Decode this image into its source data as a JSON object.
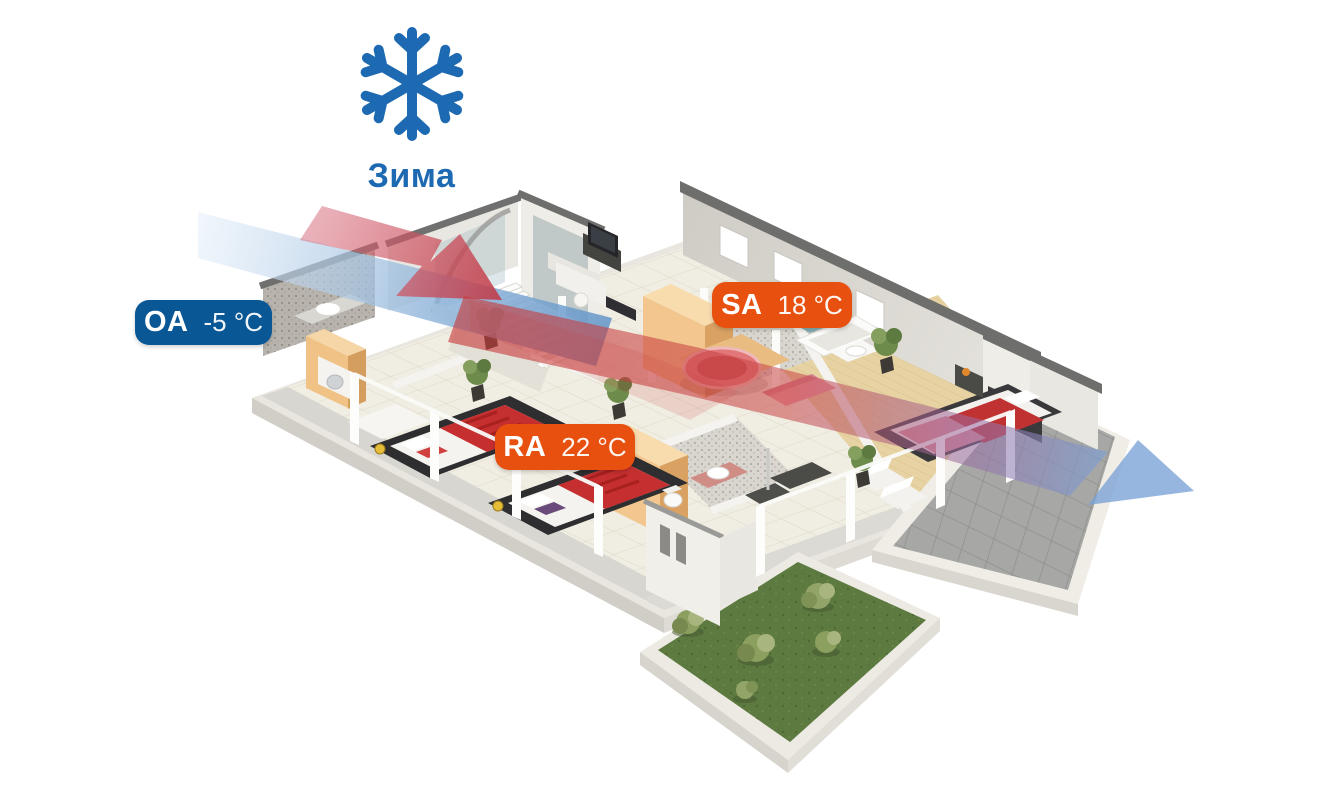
{
  "season": {
    "label": "Зима",
    "icon": "snowflake-icon",
    "color": "#1d6ab3"
  },
  "flows": [
    {
      "code": "OA",
      "temperature": "-5 °C",
      "badge_color": "#0a5796",
      "position": "outdoor-air-left"
    },
    {
      "code": "SA",
      "temperature": "18 °C",
      "badge_color": "#e8500f",
      "position": "supply-air-center"
    },
    {
      "code": "RA",
      "temperature": "22 °C",
      "badge_color": "#e8500f",
      "position": "return-air-bedroom"
    }
  ],
  "airflow_colors": {
    "cold_intake": "#6f9ecf",
    "warm_supply": "#c83a3a",
    "exhaust": "#7aa2d6"
  }
}
